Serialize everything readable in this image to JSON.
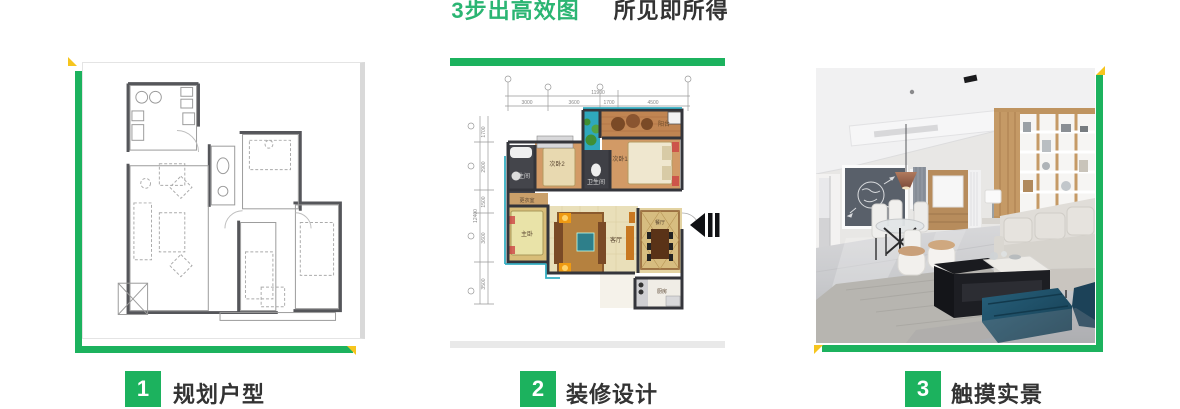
{
  "title": {
    "highlight": "3步出高效图",
    "rest": "所见即所得"
  },
  "colors": {
    "accent_green": "#1cb25e",
    "title_green": "#2bb573",
    "accent_yellow": "#f6c51e",
    "text_dark": "#333333",
    "badge_text": "#ffffff"
  },
  "steps": [
    {
      "number": "1",
      "label": "规划户型"
    },
    {
      "number": "2",
      "label": "装修设计"
    },
    {
      "number": "3",
      "label": "触摸实景"
    }
  ],
  "colored_plan": {
    "dims_top_total": "11900",
    "dims_top": [
      "3000",
      "3600",
      "1700",
      "4500"
    ],
    "dims_left_total": "12400",
    "dims_left": [
      "1700",
      "2900",
      "1500",
      "3600",
      "3500"
    ],
    "rooms": {
      "balcony": "阳台",
      "bedroom1": "次卧1",
      "bedroom2": "次卧2",
      "bath1": "卫生间",
      "bath2": "卫生间",
      "dressing": "更衣室",
      "master": "主卧",
      "living": "客厅",
      "dining": "餐厅",
      "kitchen": "厨房"
    }
  }
}
